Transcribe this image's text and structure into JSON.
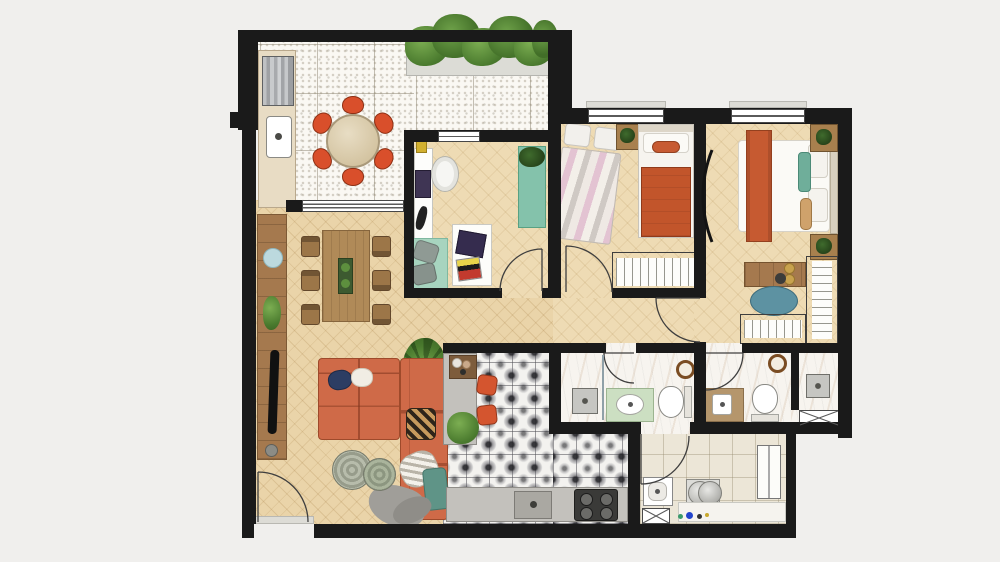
{
  "meta": {
    "title": "Furnished apartment floor plan, top view",
    "type": "architectural floor plan",
    "visible_text": "none"
  },
  "palette": {
    "background": "#f0efed",
    "wall": "#1a1a1a",
    "living_wood_floor": "#ead4a9",
    "bedroom_wood_floor": "#eedbb4",
    "terrace_tile": "#faf8f3",
    "kitchen_pattern_tile": "#3c3c42",
    "bathroom_marble": "#f7f4ef",
    "laundry_tile": "#ece6d7",
    "sofa_orange": "#cf6a48",
    "chair_orange": "#d94f2b",
    "blanket_orange": "#c2552b",
    "teal_accent": "#7fc0aa",
    "pouf_teal": "#5d92a2",
    "plant_green": "#5d8f3e",
    "wood_furniture": "#a8804e",
    "vanity_green": "#ccdfc2",
    "vanity_wood": "#b5966c"
  },
  "rooms": [
    {
      "id": "terrace",
      "name": "gourmet terrace",
      "items": [
        "barbecue grill",
        "terrace sink",
        "round dining table",
        "six orange chairs",
        "hedge planter",
        "speckled tile floor",
        "sliding glass door"
      ]
    },
    {
      "id": "living-dining",
      "name": "living and dining room",
      "items": [
        "L-shaped orange sofa",
        "throw pillows",
        "gray throw",
        "two rattan poufs",
        "tv sideboard",
        "wall plate",
        "dining table",
        "six wood chairs",
        "table runner with plants",
        "palm plant",
        "entrance door"
      ]
    },
    {
      "id": "office",
      "name": "home office",
      "items": [
        "white desk with laptop",
        "office chair",
        "teal rug",
        "two floor cushions",
        "work table with laptop and books",
        "teal bench with plant"
      ]
    },
    {
      "id": "bedroom-1",
      "name": "twin bedroom",
      "items": [
        "bed with pink striped duvet",
        "bed with orange blanket",
        "nightstand with plant",
        "wardrobe",
        "window"
      ]
    },
    {
      "id": "master-bedroom",
      "name": "master bedroom",
      "items": [
        "double bed with orange runner",
        "teal pillow",
        "two nightstands with plants",
        "dresser with decor",
        "teal pouf",
        "side wardrobe",
        "foot wardrobe",
        "arc floor lamp",
        "window"
      ]
    },
    {
      "id": "bathroom-social",
      "name": "social bathroom",
      "items": [
        "shower with glass partition",
        "green vanity with oval sink",
        "toilet",
        "round mirror"
      ]
    },
    {
      "id": "bathroom-ensuite",
      "name": "ensuite bathroom",
      "items": [
        "wood vanity with sink",
        "toilet",
        "round mirror"
      ]
    },
    {
      "id": "shower-room",
      "name": "ensuite shower room",
      "items": [
        "shower head",
        "duct shaft"
      ]
    },
    {
      "id": "kitchen",
      "name": "kitchen",
      "items": [
        "bar counter",
        "wood shelf with bowls",
        "two orange stools",
        "potted plant",
        "base counter",
        "sink",
        "four-burner cooktop",
        "patterned encaustic tile floor"
      ]
    },
    {
      "id": "laundry",
      "name": "laundry room",
      "items": [
        "laundry tank",
        "washing machine",
        "tall cabinet",
        "marble counter",
        "cleaning bottles",
        "duct shaft"
      ]
    },
    {
      "id": "hall",
      "name": "hallway",
      "items": [
        "doors to bedrooms and bathroom"
      ]
    }
  ]
}
